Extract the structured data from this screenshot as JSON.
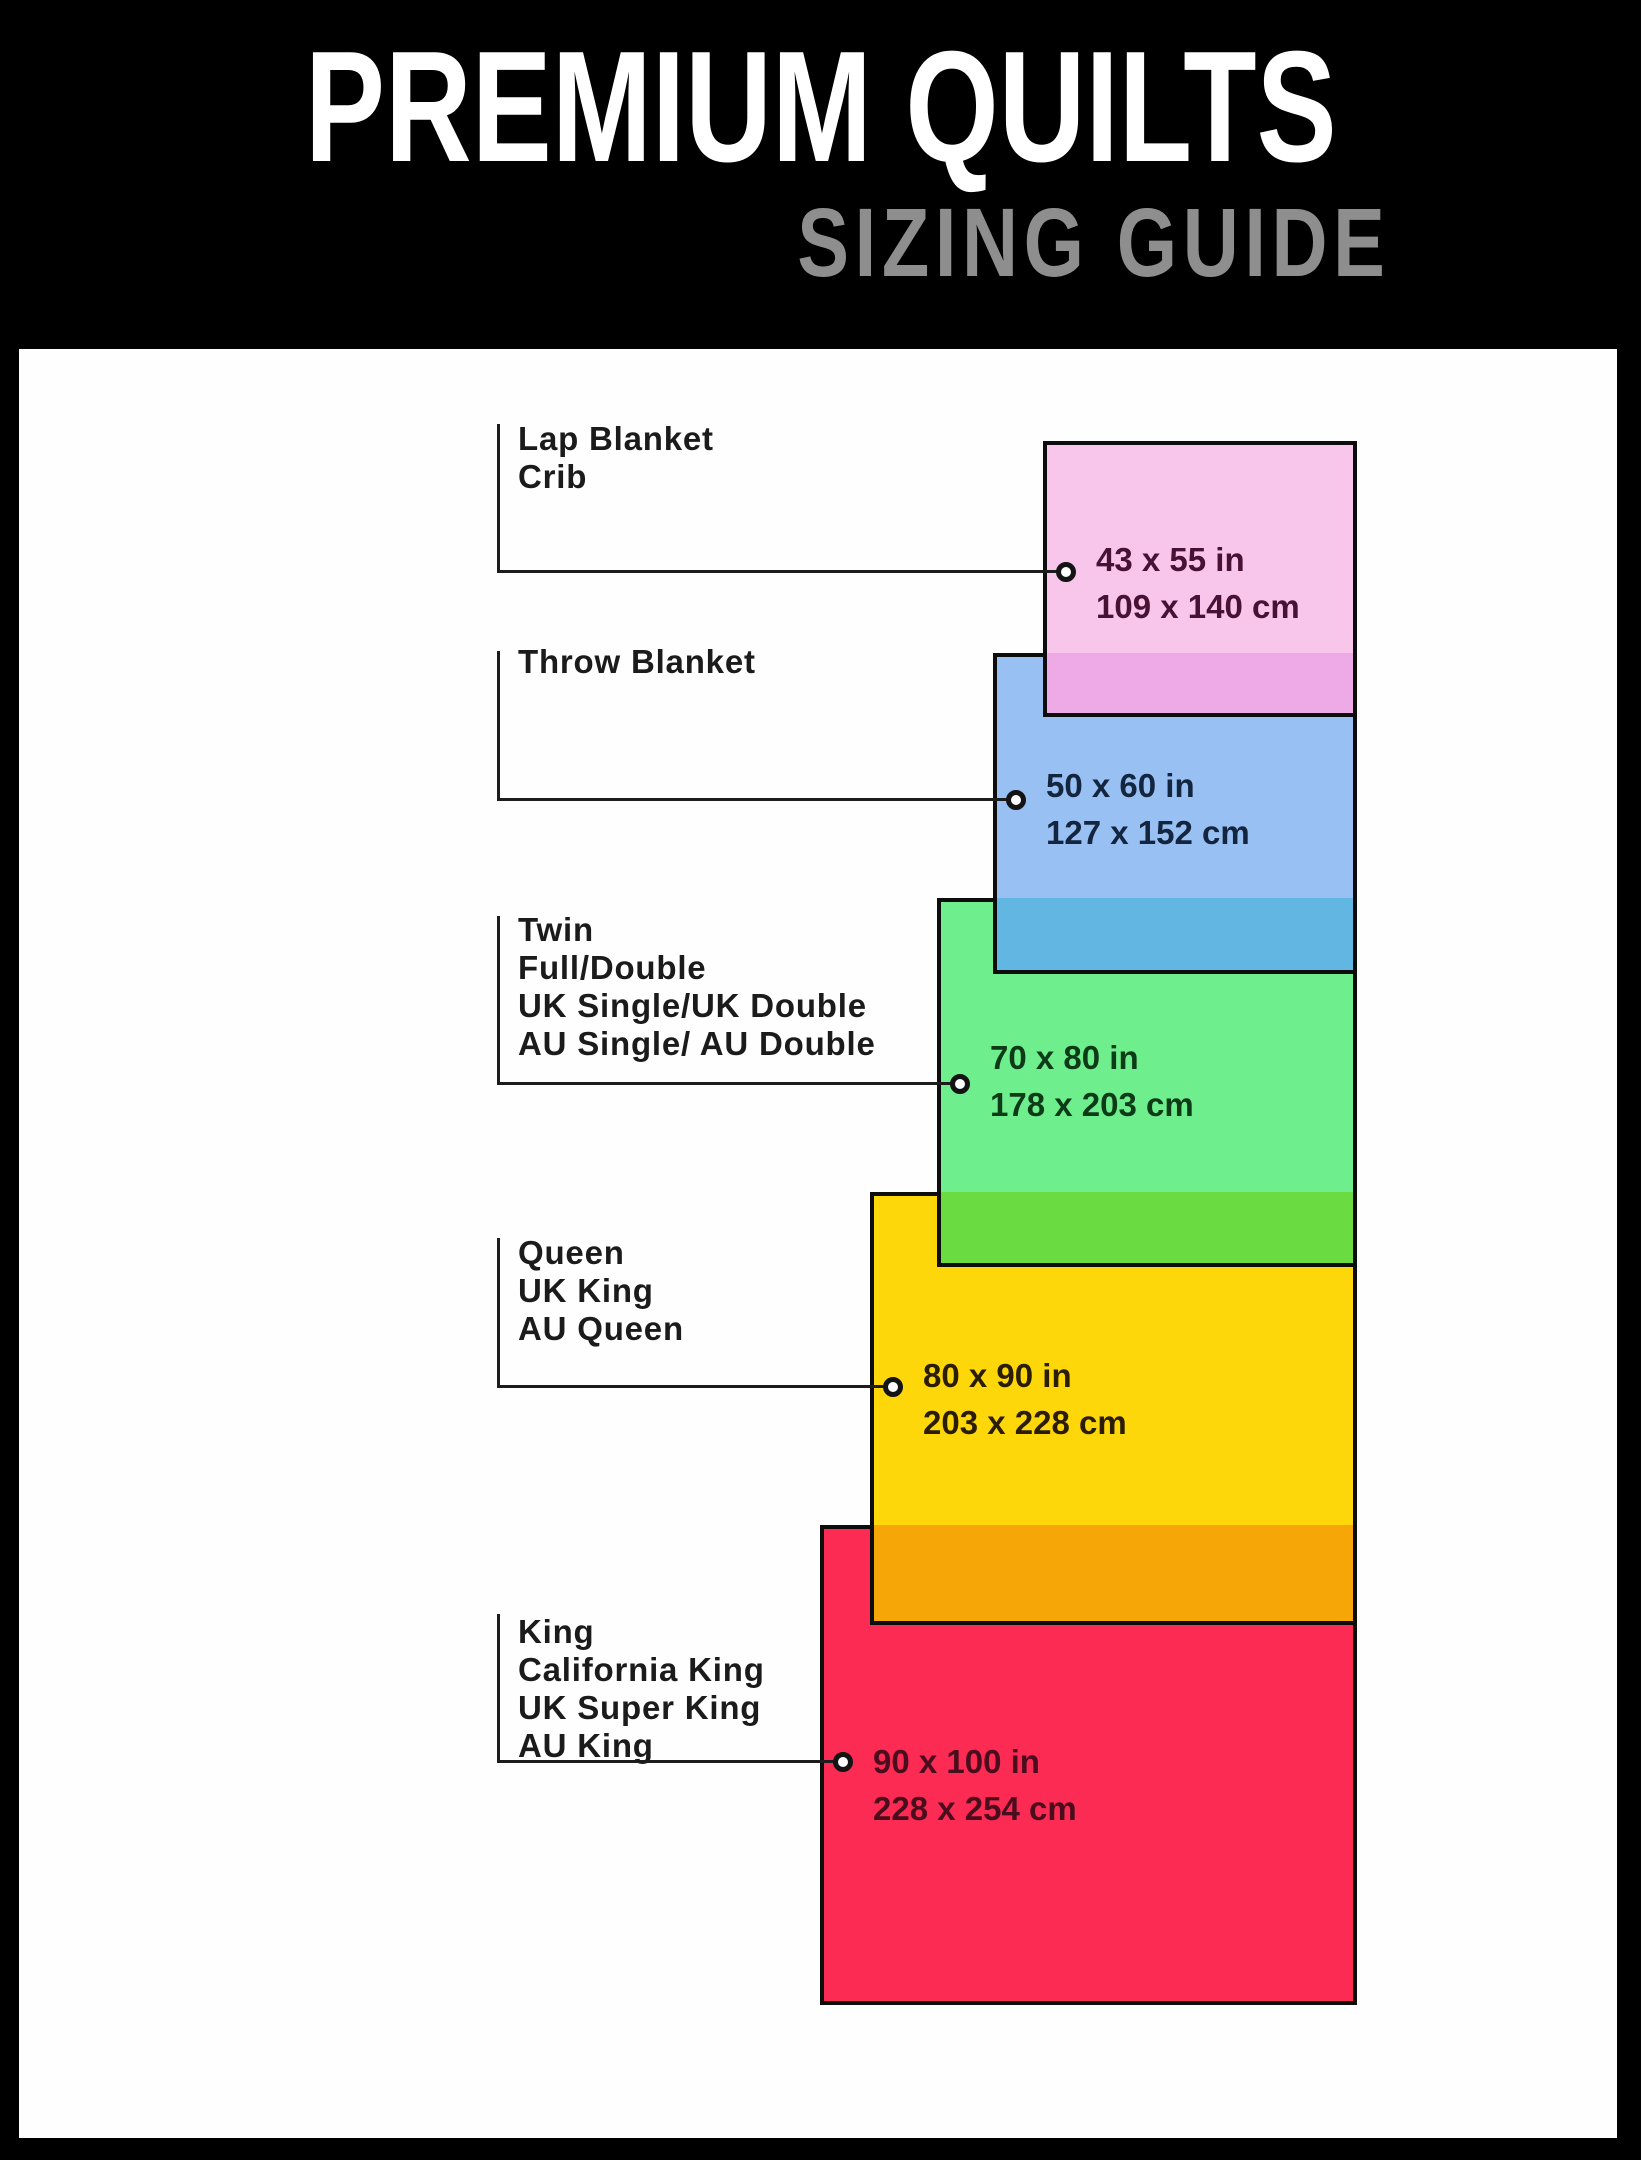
{
  "header": {
    "title": "PREMIUM QUILTS",
    "subtitle": "SIZING GUIDE"
  },
  "colors": {
    "background": "#000000",
    "panel": "#fefefe",
    "line": "#1c1c1c",
    "title_text": "#ffffff",
    "subtitle_text": "#8e8e8e",
    "label_text": "#1b1b1b",
    "rect_border": "#0d0d0d"
  },
  "sizes": [
    {
      "name": "lap-blanket-crib",
      "labels": [
        "Lap Blanket",
        "Crib"
      ],
      "inches": "43 x 55 in",
      "centimeters": "109 x 140 cm",
      "fill": "#f9c6eb",
      "overlap_fill": "#edaae7",
      "text_color": "#471233"
    },
    {
      "name": "throw-blanket",
      "labels": [
        "Throw Blanket"
      ],
      "inches": "50 x 60 in",
      "centimeters": "127 x 152 cm",
      "fill": "#98c0f2",
      "overlap_fill": "#62b7e2",
      "text_color": "#13253f"
    },
    {
      "name": "twin-full-double",
      "labels": [
        "Twin",
        "Full/Double",
        "UK Single/UK Double",
        "AU Single/ AU Double"
      ],
      "inches": "70 x 80 in",
      "centimeters": "178 x 203 cm",
      "fill": "#6fee8d",
      "overlap_fill": "#6adc41",
      "text_color": "#0d3b17"
    },
    {
      "name": "queen-uk-king-au-queen",
      "labels": [
        "Queen",
        "UK King",
        "AU Queen"
      ],
      "inches": "80 x 90 in",
      "centimeters": "203 x 228 cm",
      "fill": "#fed70a",
      "overlap_fill": "#f7a607",
      "text_color": "#2b1d00"
    },
    {
      "name": "king-california-king-uk-super-king-au-king",
      "labels": [
        "King",
        "California King",
        "UK Super King",
        "AU King"
      ],
      "inches": "90 x 100 in",
      "centimeters": "228 x 254 cm",
      "fill": "#fb2b53",
      "overlap_fill": null,
      "text_color": "#4a0d1d"
    }
  ]
}
